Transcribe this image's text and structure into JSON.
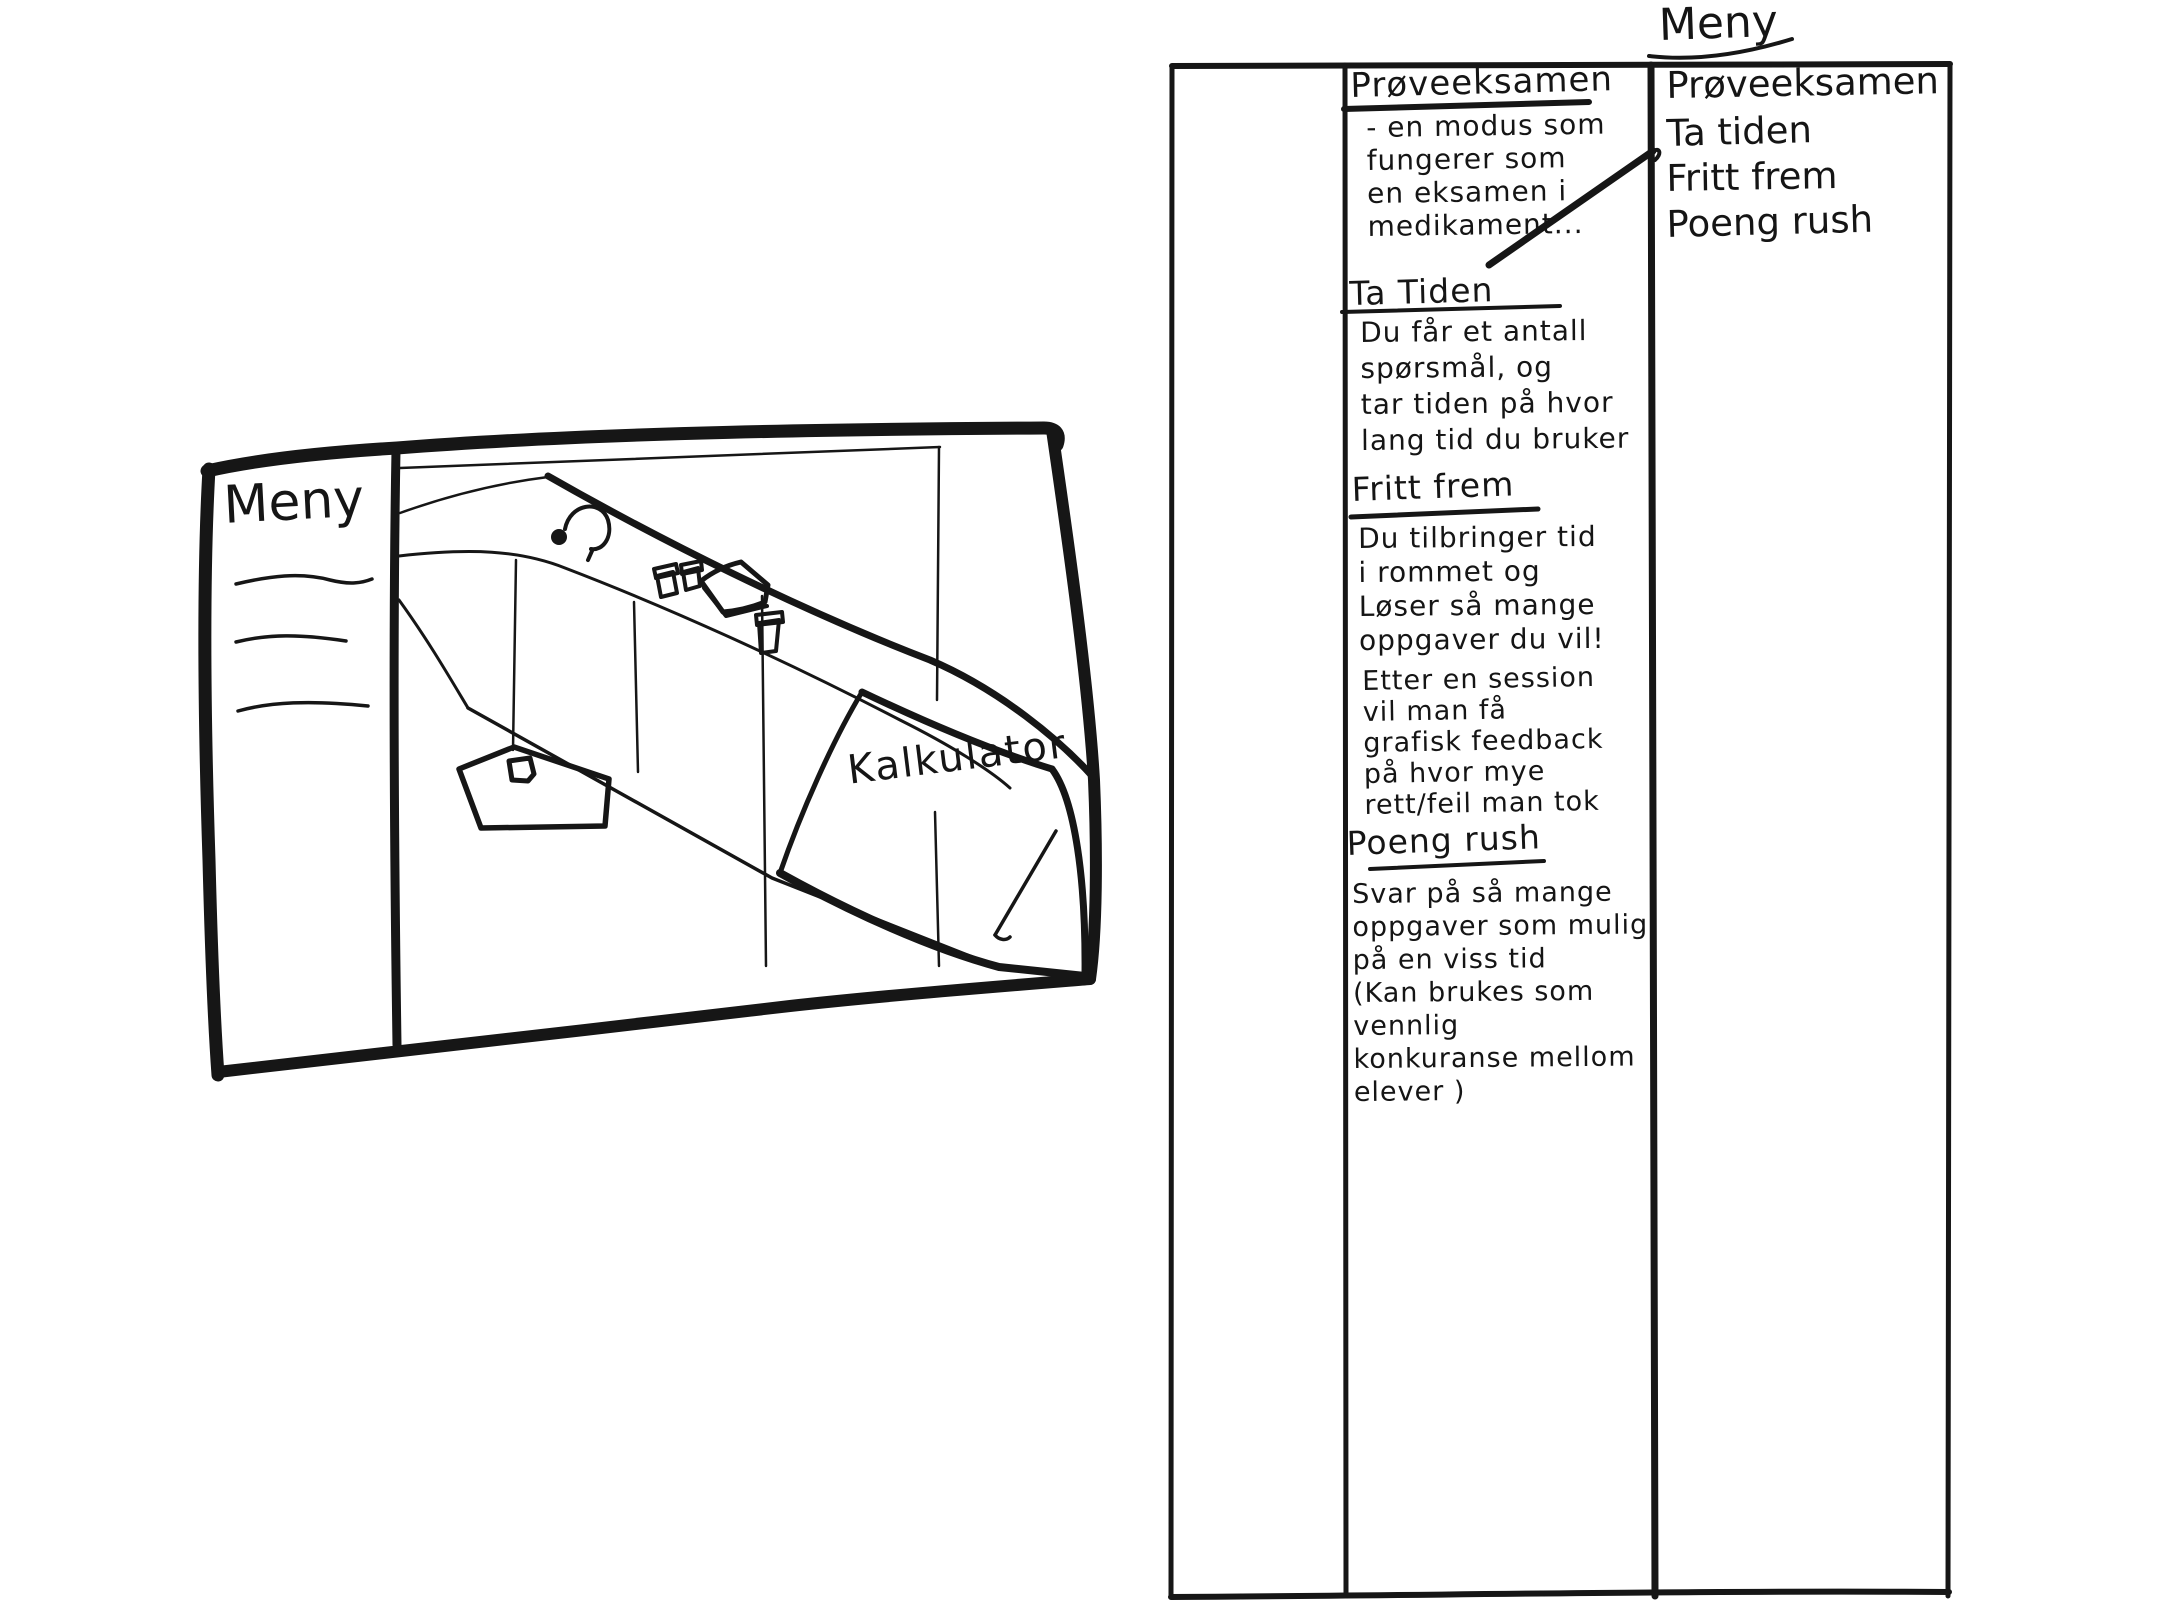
{
  "colors": {
    "background": "#ffffff",
    "ink": "#161616"
  },
  "left_sketch": {
    "sidebar": {
      "title": "Meny",
      "placeholder_line_count": 3
    },
    "scene": {
      "note_label": "Kalkulator",
      "objects": [
        "headset",
        "cup",
        "cup",
        "book",
        "cup",
        "floor-mat",
        "mouse"
      ]
    }
  },
  "right_wireframe": {
    "menu_title": "Meny",
    "menu_items": [
      "Prøveeksamen",
      "Ta tiden",
      "Fritt frem",
      "Poeng rush"
    ],
    "sections": [
      {
        "heading": "Prøveeksamen",
        "body": "- en modus som\nfungerer som\nen eksamen i\nmedikament..."
      },
      {
        "heading": "Ta Tiden",
        "body": "Du får et antall\nspørsmål, og\ntar tiden på hvor\nlang tid du bruker"
      },
      {
        "heading": "Fritt frem",
        "body": "Du tilbringer tid\ni rommet og\nLøser så mange\noppgaver du vil!",
        "body2": "Etter en session\nvil man få\ngrafisk feedback\npå hvor mye\nrett/feil man tok"
      },
      {
        "heading": "Poeng rush",
        "body": "Svar på så mange\noppgaver som mulig\npå en viss tid\n(Kan brukes som vennlig\nkonkuranse mellom\nelever )"
      }
    ]
  }
}
